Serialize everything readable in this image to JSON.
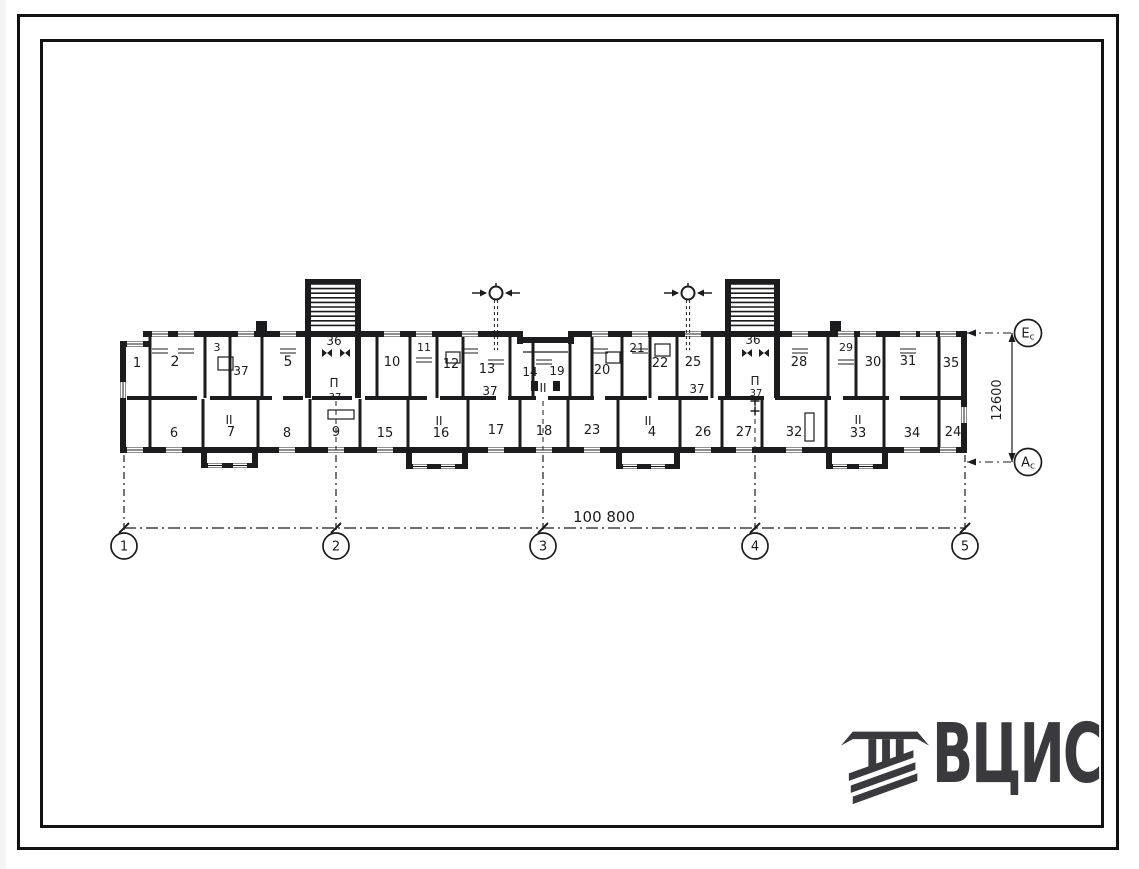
{
  "page": {
    "background": "#ffffff",
    "ink": "#1c1c1e"
  },
  "logo": {
    "text": "ВЦИС",
    "color": "#3a3a3e",
    "emblem_icon": "construction-monogram"
  },
  "dimensions": {
    "horizontal": "100 800",
    "vertical": "12600"
  },
  "axes": {
    "bottom": [
      {
        "label": "1",
        "x": 124
      },
      {
        "label": "2",
        "x": 336
      },
      {
        "label": "3",
        "x": 543
      },
      {
        "label": "4",
        "x": 755
      },
      {
        "label": "5",
        "x": 965
      }
    ],
    "bottom_cy": 546,
    "right": [
      {
        "label": "E",
        "sub": "c",
        "y": 333
      },
      {
        "label": "A",
        "sub": "c",
        "y": 462
      }
    ],
    "right_cx": 1028
  },
  "rooms": {
    "labels": [
      [
        "1",
        137,
        363,
        13
      ],
      [
        "2",
        175,
        362,
        14
      ],
      [
        "3",
        217,
        347,
        11
      ],
      [
        "37",
        241,
        371,
        12
      ],
      [
        "5",
        288,
        362,
        14
      ],
      [
        "36",
        334,
        341,
        12
      ],
      [
        "10",
        392,
        362,
        13
      ],
      [
        "11",
        424,
        347,
        11
      ],
      [
        "12",
        451,
        364,
        13
      ],
      [
        "13",
        487,
        369,
        13
      ],
      [
        "37",
        490,
        391,
        12
      ],
      [
        "14",
        530,
        372,
        12
      ],
      [
        "19",
        557,
        371,
        12
      ],
      [
        "20",
        602,
        370,
        13
      ],
      [
        "21",
        637,
        348,
        12
      ],
      [
        "22",
        660,
        363,
        13
      ],
      [
        "25",
        693,
        362,
        13
      ],
      [
        "37",
        697,
        389,
        12
      ],
      [
        "36",
        753,
        340,
        12
      ],
      [
        "28",
        799,
        362,
        13
      ],
      [
        "29",
        846,
        347,
        11
      ],
      [
        "30",
        873,
        362,
        13
      ],
      [
        "31",
        908,
        361,
        13
      ],
      [
        "35",
        951,
        363,
        13
      ],
      [
        "6",
        174,
        433,
        13
      ],
      [
        "7",
        231,
        432,
        13
      ],
      [
        "8",
        287,
        433,
        13
      ],
      [
        "9",
        336,
        432,
        13
      ],
      [
        "15",
        385,
        433,
        13
      ],
      [
        "16",
        441,
        433,
        13
      ],
      [
        "17",
        496,
        430,
        13
      ],
      [
        "18",
        544,
        431,
        13
      ],
      [
        "23",
        592,
        430,
        13
      ],
      [
        "4",
        652,
        432,
        13
      ],
      [
        "26",
        703,
        432,
        13
      ],
      [
        "27",
        744,
        432,
        13
      ],
      [
        "32",
        794,
        432,
        13
      ],
      [
        "33",
        858,
        433,
        13
      ],
      [
        "34",
        912,
        433,
        13
      ],
      [
        "24",
        953,
        432,
        13
      ],
      [
        "II",
        229,
        420,
        12
      ],
      [
        "II",
        439,
        421,
        12
      ],
      [
        "II",
        648,
        421,
        12
      ],
      [
        "II",
        858,
        420,
        12
      ],
      [
        "II",
        543,
        388,
        12
      ],
      [
        "П",
        334,
        383,
        12
      ],
      [
        "37",
        335,
        396,
        10
      ],
      [
        "П",
        755,
        381,
        12
      ],
      [
        "37",
        756,
        392,
        10
      ]
    ]
  },
  "geometry": {
    "walls": [
      [
        120,
        341,
        31,
        6
      ],
      [
        120,
        341,
        6,
        112
      ],
      [
        143,
        331,
        379,
        6
      ],
      [
        517,
        331,
        6,
        13
      ],
      [
        517,
        337,
        57,
        6
      ],
      [
        568,
        331,
        6,
        13
      ],
      [
        571,
        331,
        396,
        6
      ],
      [
        961,
        331,
        6,
        122
      ],
      [
        120,
        447,
        847,
        6
      ],
      [
        305,
        279,
        56,
        5
      ],
      [
        305,
        279,
        6,
        58
      ],
      [
        355,
        279,
        6,
        58
      ],
      [
        725,
        279,
        55,
        5
      ],
      [
        725,
        279,
        6,
        58
      ],
      [
        774,
        279,
        6,
        58
      ],
      [
        305,
        337,
        6,
        61
      ],
      [
        355,
        337,
        6,
        61
      ],
      [
        725,
        337,
        6,
        61
      ],
      [
        774,
        337,
        6,
        61
      ],
      [
        201,
        450,
        6,
        16
      ],
      [
        252,
        450,
        6,
        16
      ],
      [
        201,
        463,
        57,
        5
      ],
      [
        406,
        450,
        6,
        17
      ],
      [
        462,
        450,
        6,
        17
      ],
      [
        406,
        464,
        62,
        5
      ],
      [
        616,
        450,
        6,
        17
      ],
      [
        674,
        450,
        6,
        17
      ],
      [
        616,
        464,
        64,
        5
      ],
      [
        826,
        450,
        6,
        17
      ],
      [
        882,
        450,
        6,
        17
      ],
      [
        826,
        464,
        62,
        5
      ],
      [
        256,
        321,
        11,
        11
      ],
      [
        830,
        321,
        11,
        11
      ],
      [
        531,
        381,
        7,
        10
      ],
      [
        553,
        381,
        7,
        10
      ]
    ],
    "spine_y": 396,
    "spine": [
      [
        127,
        70
      ],
      [
        210,
        62
      ],
      [
        283,
        20
      ],
      [
        312,
        40
      ],
      [
        365,
        62
      ],
      [
        440,
        56
      ],
      [
        508,
        28
      ],
      [
        548,
        46
      ],
      [
        605,
        42
      ],
      [
        658,
        50
      ],
      [
        718,
        46
      ],
      [
        775,
        56
      ],
      [
        843,
        46
      ],
      [
        900,
        61
      ]
    ],
    "partitions_top": [
      150,
      205,
      230,
      262,
      377,
      410,
      437,
      463,
      510,
      533,
      570,
      592,
      622,
      650,
      677,
      712,
      828,
      856,
      884,
      939
    ],
    "partitions_bottom": [
      150,
      203,
      258,
      310,
      360,
      408,
      468,
      520,
      568,
      618,
      680,
      722,
      762,
      826,
      884,
      939
    ],
    "windows_h": [
      [
        160,
        331
      ],
      [
        186,
        331
      ],
      [
        246,
        331
      ],
      [
        288,
        331
      ],
      [
        392,
        331
      ],
      [
        424,
        331
      ],
      [
        470,
        331
      ],
      [
        600,
        331
      ],
      [
        640,
        331
      ],
      [
        693,
        331
      ],
      [
        800,
        331
      ],
      [
        846,
        331
      ],
      [
        868,
        331
      ],
      [
        908,
        331
      ],
      [
        928,
        331
      ],
      [
        948,
        331
      ],
      [
        135,
        341
      ],
      [
        135,
        447
      ],
      [
        174,
        447
      ],
      [
        287,
        447
      ],
      [
        336,
        447
      ],
      [
        385,
        447
      ],
      [
        496,
        447
      ],
      [
        544,
        447
      ],
      [
        592,
        447
      ],
      [
        703,
        447
      ],
      [
        744,
        447
      ],
      [
        794,
        447
      ],
      [
        912,
        447
      ],
      [
        948,
        447
      ],
      [
        215,
        463
      ],
      [
        240,
        463
      ],
      [
        420,
        464
      ],
      [
        448,
        464
      ],
      [
        630,
        464
      ],
      [
        658,
        464
      ],
      [
        840,
        464
      ],
      [
        866,
        464
      ]
    ],
    "windows_v": [
      [
        120,
        390
      ],
      [
        961,
        415
      ]
    ],
    "stair_hatch": [
      [
        311,
        356
      ],
      [
        731,
        775
      ]
    ],
    "vents": [
      496,
      688
    ],
    "bowties": [
      [
        327,
        353
      ],
      [
        345,
        353
      ],
      [
        747,
        353
      ],
      [
        764,
        353
      ]
    ],
    "crosses": [
      [
        755,
        401
      ],
      [
        755,
        411
      ]
    ],
    "small_rects": [
      [
        218,
        357,
        15,
        13
      ],
      [
        655,
        344,
        15,
        12
      ],
      [
        446,
        352,
        14,
        11
      ],
      [
        606,
        352,
        14,
        11
      ],
      [
        328,
        410,
        26,
        9
      ],
      [
        805,
        413,
        9,
        28
      ]
    ],
    "radiators": [
      [
        160,
        341
      ],
      [
        186,
        341
      ],
      [
        288,
        341
      ],
      [
        424,
        350
      ],
      [
        470,
        341
      ],
      [
        600,
        341
      ],
      [
        640,
        341
      ],
      [
        800,
        341
      ],
      [
        846,
        352
      ],
      [
        908,
        341
      ],
      [
        496,
        352
      ],
      [
        544,
        352
      ]
    ],
    "thin_lines": [
      [
        523,
        352,
        568,
        352
      ]
    ],
    "inner_axis_dashes": [
      336,
      543,
      755
    ],
    "dim_h": {
      "y": 528,
      "x1": 124,
      "x2": 965,
      "tx": 604,
      "ty": 522
    },
    "dim_v": {
      "x": 1012,
      "y1": 333,
      "y2": 462,
      "tx": 1001,
      "ty": 400
    },
    "axis_drop_y1": 455,
    "axis_drop_y2": 533,
    "right_lead_x1": 967,
    "right_lead_x2": 1014
  }
}
